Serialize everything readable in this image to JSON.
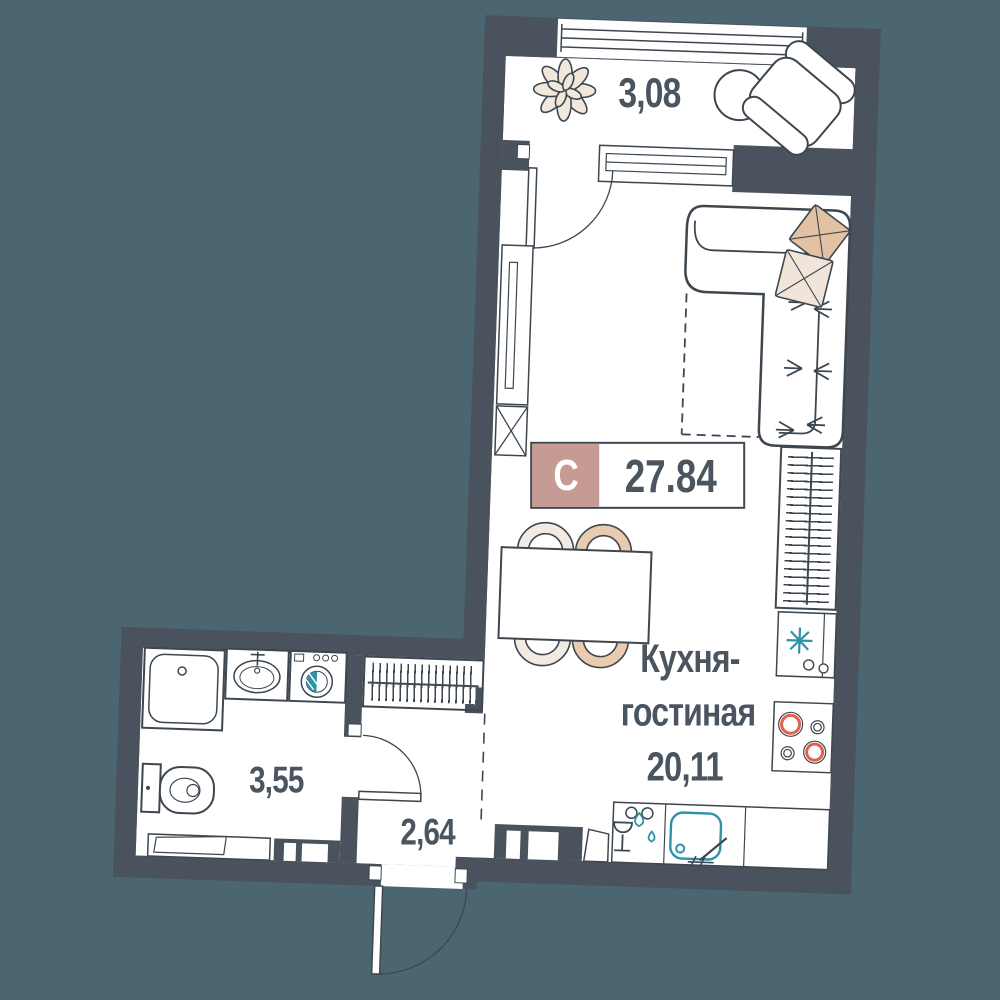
{
  "apartment": {
    "type_letter": "С",
    "total_area": "27.84"
  },
  "rooms": {
    "loggia": {
      "area": "3,08"
    },
    "kitchen_living": {
      "label_line1": "Кухня-",
      "label_line2": "гостиная",
      "area": "20,11"
    },
    "bathroom": {
      "area": "3,55"
    },
    "hall": {
      "area": "2,64"
    }
  },
  "icons": [
    "plant-icon",
    "round-table-icon",
    "armchair-icon",
    "sofa-icon",
    "pillow-icon",
    "dining-table-icon",
    "chair-icon",
    "wardrobe-icon",
    "radiator-icon",
    "fridge-icon",
    "snowflake-icon",
    "stove-icon",
    "dishwasher-icon",
    "kitchen-sink-icon",
    "shower-icon",
    "washbasin-icon",
    "washing-machine-icon",
    "toilet-icon",
    "door-arc-icon",
    "window-icon"
  ],
  "colors": {
    "background": "#4B6671",
    "wall": "#4A525D",
    "line": "#3E4750",
    "text": "#4A5560",
    "badge_pink": "#C69B93",
    "accent_teal": "#2E93A8",
    "burner_red": "#E2614B",
    "pillow_tan": "#E3C1A3",
    "pillow_cream": "#F1E4D9",
    "chair_tan": "#E9CBB0",
    "chair_cream": "#F1EBE3",
    "plant_fill": "#F2E7DC"
  }
}
